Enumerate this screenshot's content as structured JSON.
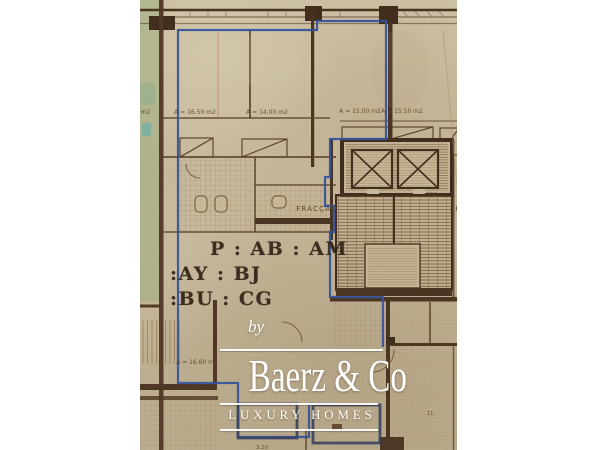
{
  "plan": {
    "area_labels": [
      "m2",
      "A = 16.50 m2",
      "A = 14.00 m2",
      "A = 15.00 m2",
      "A = 15.50 m2",
      "A = 16.60 m2"
    ],
    "fraccao": "FRACÇÃO",
    "fraccao_partial": "FR",
    "num_116": "116",
    "num_11": "11",
    "dim_320": "3.20",
    "colors": {
      "paper": "#c8bb9e",
      "wall_brown": "#4f3722",
      "dark_brown": "#3b2817",
      "outline_blue": "#35529b",
      "navy": "#2d3a5c",
      "green_strip": "#97ad7c",
      "teal_patch": "#6fb3a4",
      "stamp_ink": "#2e2013",
      "watermark_white": "#ffffff"
    }
  },
  "stamp": {
    "line1": "P : AB : AM",
    "line2": ":AY : BJ",
    "line3": ":BU : CG"
  },
  "watermark": {
    "by": "by",
    "brand": "Baerz & Co",
    "tagline": "LUXURY HOMES"
  }
}
